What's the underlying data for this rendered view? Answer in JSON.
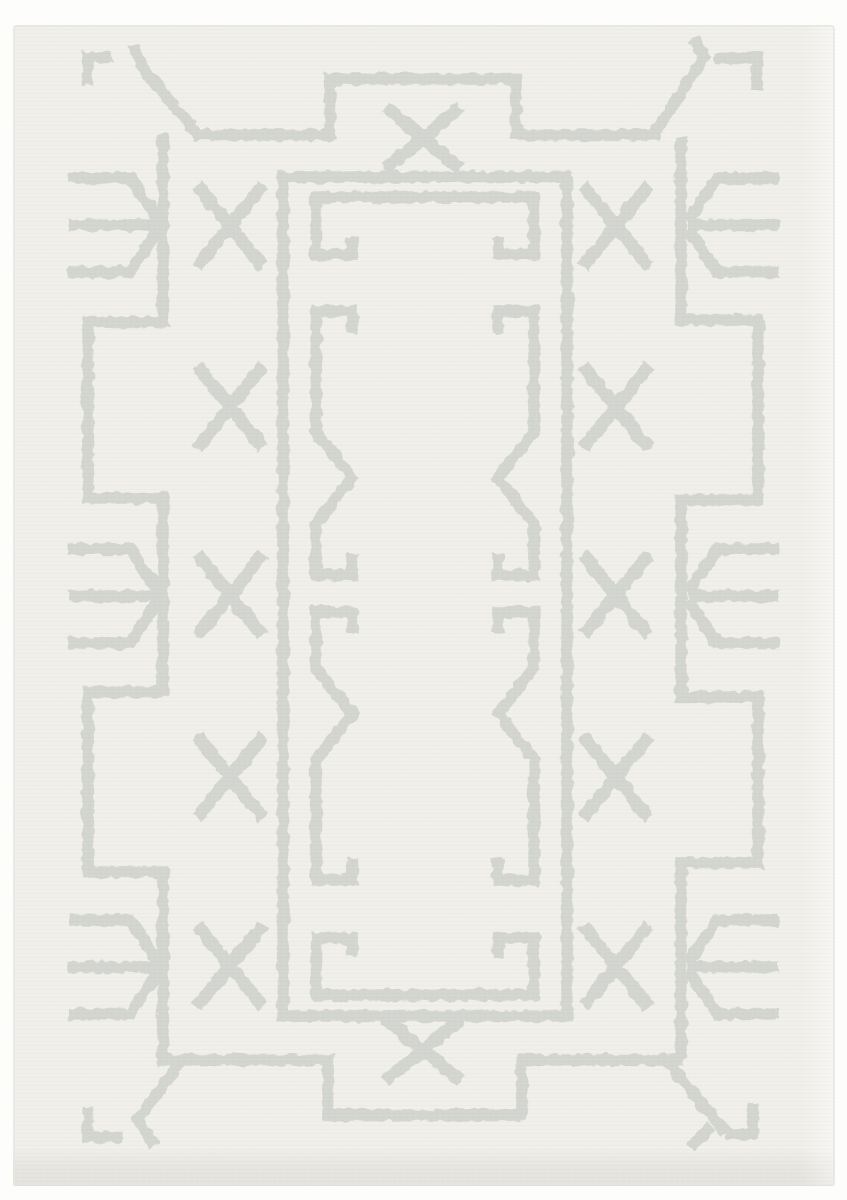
{
  "scene": {
    "description": "Top-down product photograph of a rectangular ivory area rug with a tonal light-gray tufted geometric Berber-style pattern",
    "subject": "area-rug",
    "text_content": "none"
  },
  "canvas": {
    "width": 847,
    "height": 1200
  },
  "colors": {
    "page_background": "#fdfdfc",
    "rug_base": "#f2f1ec",
    "pattern_line": "#d2d4cf",
    "edge_shade": "#e6e5e0",
    "grain": "#8c8a84"
  },
  "rug": {
    "bounds": {
      "x": 13,
      "y": 25,
      "width": 822,
      "height": 1161
    },
    "corner_radius": 3
  },
  "pattern": {
    "stroke": {
      "line_width": 11.5,
      "x_width": 13,
      "opacity": 0.92
    },
    "border_paths": [
      {
        "name": "outer-border-top",
        "d": "M 193 135 H 330 V 79 H 516 V 135 H 660"
      },
      {
        "name": "outer-border-left",
        "d": "M 163 134 V 322 H 88 V 498 H 163 V 692 H 88 V 872 H 163 V 1058"
      },
      {
        "name": "outer-border-bottom",
        "d": "M 158 1060 H 328 V 1115 H 522 V 1060 H 684"
      },
      {
        "name": "outer-border-right",
        "d": "M 681 1058 V 863 H 758 V 697 H 681 V 500 H 758 V 320 H 681 V 137"
      },
      {
        "name": "inner-rect-outline",
        "d": "M 283 177 H 567 V 1016 H 283 Z"
      },
      {
        "name": "inner-frame-top-keys",
        "d": "M 352 237 V 254 H 316 V 197 H 534 V 254 H 498 V 237"
      },
      {
        "name": "inner-frame-bottom-keys",
        "d": "M 352 957 V 938 H 316 V 995 H 534 V 938 H 498 V 957"
      },
      {
        "name": "meander-left-upper",
        "d": "M 352 333 V 311 H 316 V 432 L 352 478 L 316 524 V 575 H 352 V 553"
      },
      {
        "name": "meander-left-lower",
        "d": "M 352 633 V 612 H 316 V 668 L 352 714 L 316 760 V 880 H 352 V 858"
      },
      {
        "name": "meander-right-upper",
        "d": "M 498 333 V 311 H 534 V 432 L 498 478 L 534 524 V 575 H 498 V 553"
      },
      {
        "name": "meander-right-lower",
        "d": "M 498 633 V 612 H 534 V 668 L 498 714 L 534 760 V 880 H 498 V 858"
      },
      {
        "name": "corner-top-left-diagonal",
        "d": "M 197 134 L 143 68 L 133 45"
      },
      {
        "name": "corner-top-left-bracket",
        "d": "M 112 57 H 88 V 85"
      },
      {
        "name": "corner-top-right-diagonal",
        "d": "M 654 134 L 704 57 L 693 38"
      },
      {
        "name": "corner-top-right-bracket",
        "d": "M 714 58 H 757 V 90"
      },
      {
        "name": "corner-bottom-left-diagonal",
        "d": "M 181 1061 L 138 1119 L 155 1147"
      },
      {
        "name": "corner-bottom-left-bracket",
        "d": "M 122 1137 H 88 V 1107"
      },
      {
        "name": "corner-bottom-right-diagonal",
        "d": "M 667 1061 L 726 1133 M 711 1126 L 691 1148"
      },
      {
        "name": "corner-bottom-right-bracket",
        "d": "M 726 1134 H 753 V 1103"
      }
    ],
    "tridents": {
      "prong_offset": 47,
      "tip_dy": 4,
      "left": {
        "outer_x": 68,
        "inner_x": 130,
        "point_x": 159,
        "cys": [
          225,
          596,
          967
        ]
      },
      "right": {
        "outer_x": 779,
        "inner_x": 717,
        "point_x": 688,
        "cys": [
          225,
          596,
          967
        ]
      }
    },
    "x_motifs": {
      "side_half_w": 33,
      "side_half_h": 41,
      "center_half_w": 38,
      "center_half_h": 31,
      "left_column_x": 230,
      "right_column_x": 616,
      "column_cys": [
        226,
        407,
        595,
        777,
        966
      ],
      "center_x": 423,
      "center_cys": [
        138,
        1050
      ]
    }
  }
}
